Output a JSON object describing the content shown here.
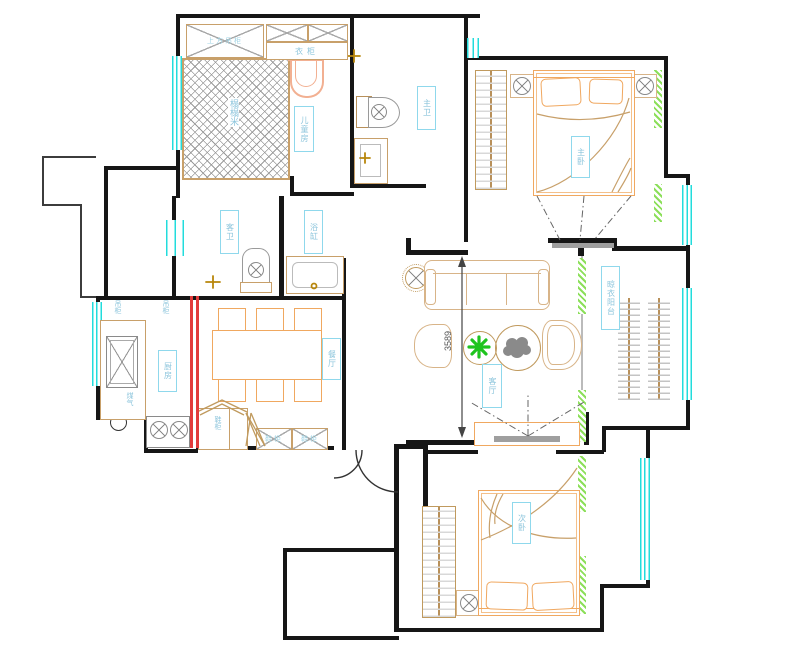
{
  "title": "apartment-floor-plan",
  "labels": {
    "children_room": "儿童房",
    "tatami": "榻榻米",
    "top_cabinet": "上方吊柜",
    "wardrobe": "衣柜",
    "master_bath": "主卫",
    "master_bedroom": "主卧",
    "living_room": "客厅",
    "drying_balcony": "晾衣阳台",
    "kitchen": "厨房",
    "hanging_cabinet_1": "吊柜",
    "hanging_cabinet_2": "吊柜",
    "gas_meter": "煤气",
    "dining_room": "餐厅",
    "guest_bath": "客卫",
    "bathtub": "浴缸",
    "entry_cabinet": "鞋柜",
    "shoe_cabinet_1": "鞋柜",
    "shoe_cabinet_2": "鞋柜",
    "secondary_bedroom": "次卧"
  },
  "dimension": {
    "living_room_height_mm": "3589"
  },
  "colors": {
    "wall": "#161616",
    "window_cyan": "#22dcdc",
    "furniture_orange": "#f0a860",
    "cabinet_tan": "#c8a06a",
    "label_cyan": "#8fd8ec",
    "curtain_green": "#8cdf5a",
    "sliding_door_red": "#e23b3b",
    "plant_green": "#1ec41e",
    "detail_gray": "#8a8a8a"
  }
}
